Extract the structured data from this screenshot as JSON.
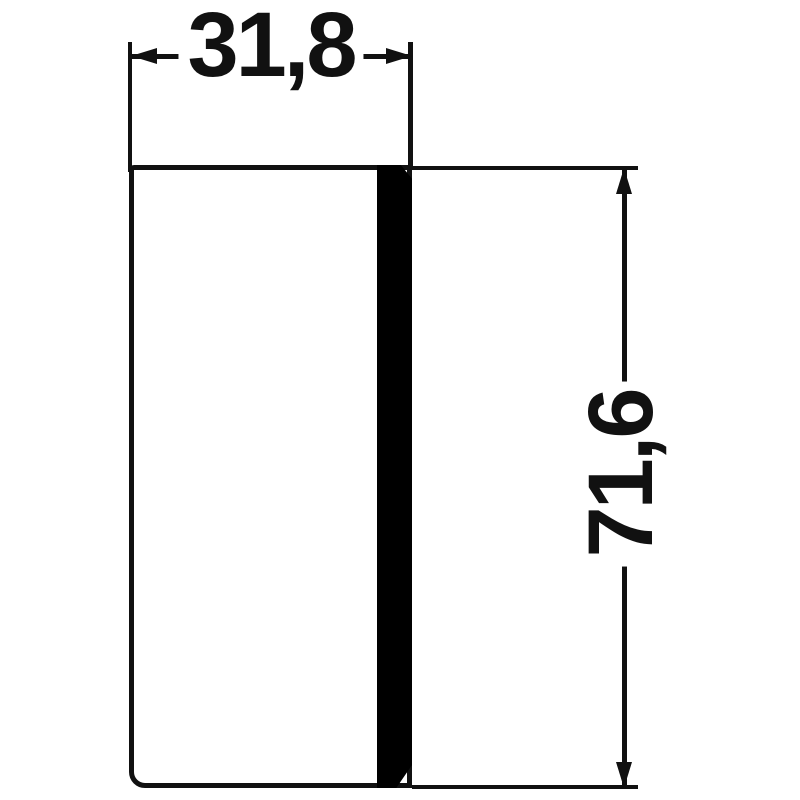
{
  "drawing": {
    "type": "technical-dimension-drawing",
    "part": "rectangular lens / cap profile, side view",
    "dimensions": {
      "width": {
        "value": "31,8",
        "orientation": "horizontal",
        "position": "top"
      },
      "height": {
        "value": "71,6",
        "orientation": "vertical-rotated-90ccw",
        "position": "right"
      }
    },
    "colors": {
      "line": "#111111",
      "fill": "#000000",
      "background": "#ffffff"
    }
  }
}
